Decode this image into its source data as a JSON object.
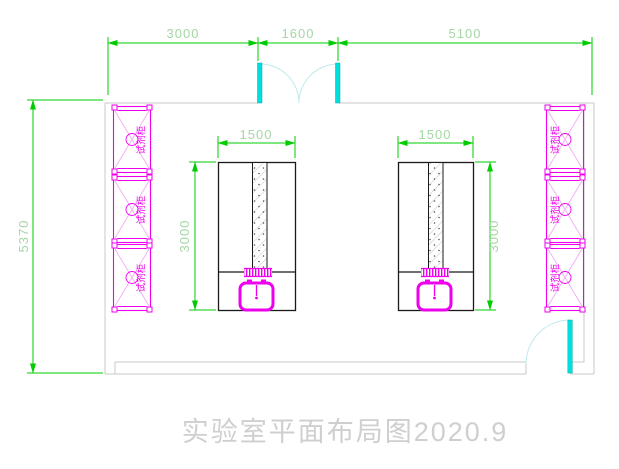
{
  "title": {
    "text": "实验室平面布局图2020.9"
  },
  "dimensions": {
    "top_left_span": "3000",
    "top_door_span": "1600",
    "top_right_span": "5100",
    "room_height": "5370",
    "bench_left_width": "1500",
    "bench_left_depth": "3000",
    "bench_right_width": "1500",
    "bench_right_depth": "3000"
  },
  "cabinets": {
    "label": "试剂柜",
    "left_count": 3,
    "right_count": 3
  },
  "colors": {
    "dimension_line": "#00cc00",
    "dimension_text": "#a5d6a5",
    "cabinet_magenta": "#ee00ee",
    "door_cyan": "#00dede",
    "door_arc_cyan": "#bfeaee",
    "wall_gray": "#c9c9c9",
    "bench_black": "#1a1a1a",
    "title_gray": "#cfcfcf"
  }
}
